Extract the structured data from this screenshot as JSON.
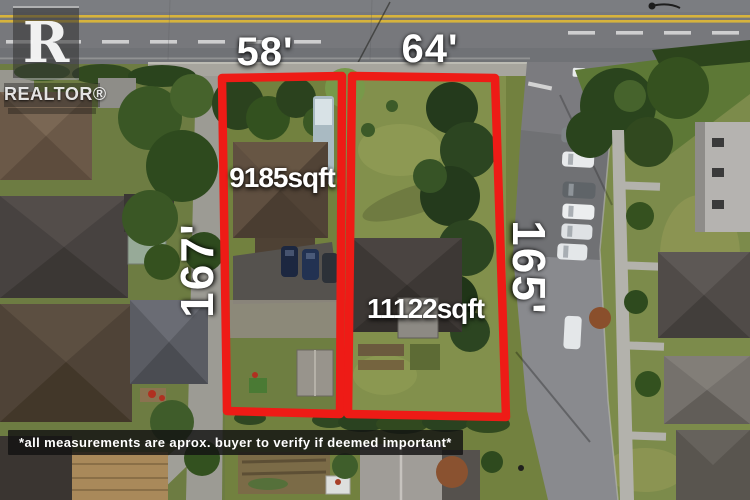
{
  "watermark": {
    "logo_letter": "R",
    "brand": "REALTOR®"
  },
  "labels": {
    "lot1_width": "58'",
    "lot2_width": "64'",
    "lot1_depth": "167'",
    "lot2_depth": "165'",
    "lot1_area": "9185sqft",
    "lot2_area": "11122sqft"
  },
  "disclaimer": "*all measurements are aprox. buyer to verify if deemed important*",
  "colors": {
    "boundary": "#ee1b16",
    "label": "#ffffff"
  }
}
